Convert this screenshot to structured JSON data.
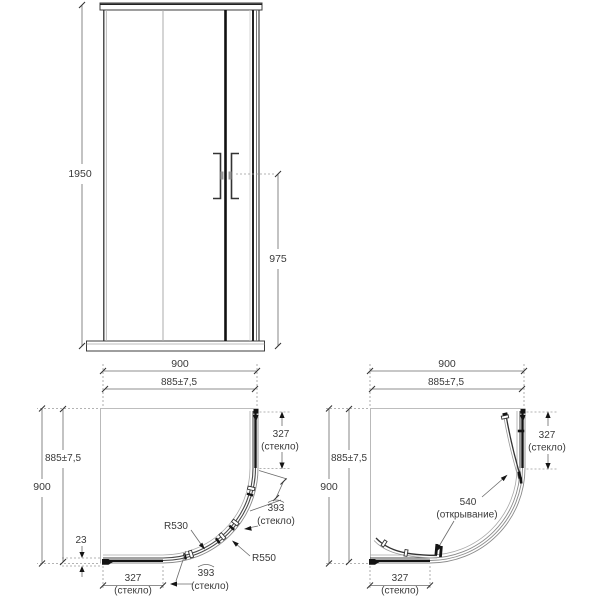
{
  "front": {
    "overall_height": "1950",
    "handle_height": "975"
  },
  "plan_closed": {
    "overall_width": "900",
    "adjust_width": "885±7,5",
    "overall_depth": "900",
    "adjust_depth": "885±7,5",
    "profile_offset": "23",
    "bottom_glass": "327",
    "bottom_glass_note": "(стекло)",
    "bottom_door_arc": "393",
    "bottom_door_arc_note": "(стекло)",
    "side_glass": "327",
    "side_glass_note": "(стекло)",
    "side_door_arc": "393",
    "side_door_arc_note": "(стекло)",
    "radius_inner": "R530",
    "radius_outer": "R550"
  },
  "plan_open": {
    "overall_width": "900",
    "adjust_width": "885±7,5",
    "overall_depth": "900",
    "adjust_depth": "885±7,5",
    "side_glass": "327",
    "side_glass_note": "(стекло)",
    "bottom_glass": "327",
    "bottom_glass_note": "(стекло)",
    "opening": "540",
    "opening_note": "(открывание)"
  },
  "colors": {
    "line": "#3a3a3a",
    "glass": "#141414"
  }
}
